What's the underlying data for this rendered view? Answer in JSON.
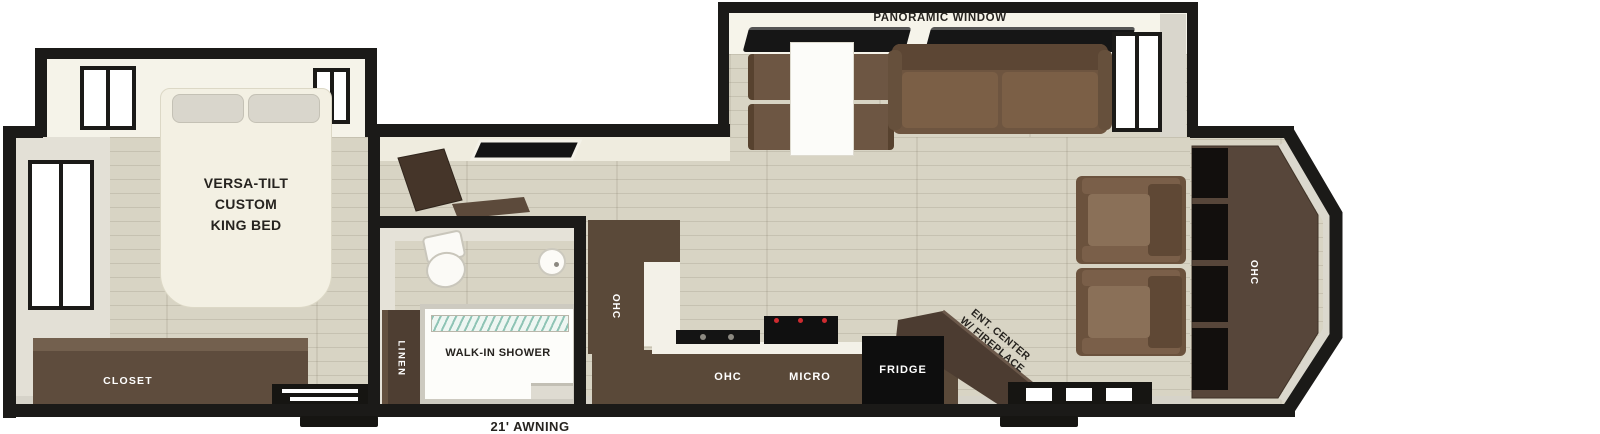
{
  "plan": {
    "front_bedroom": {
      "bed_line1": "VERSA-TILT",
      "bed_line2": "CUSTOM",
      "bed_line3": "KING BED",
      "closet": "CLOSET"
    },
    "bathroom": {
      "linen": "LINEN",
      "shower": "WALK-IN SHOWER"
    },
    "kitchen": {
      "ohc_wall": "OHC",
      "ohc_counter": "OHC",
      "micro": "MICRO",
      "fridge": "FRIDGE"
    },
    "living": {
      "panoramic_window": "PANORAMIC WINDOW",
      "ent_center_line1": "ENT. CENTER",
      "ent_center_line2": "W/ FIREPLACE",
      "ohc_rear": "OHC"
    },
    "exterior": {
      "awning": "21' AWNING"
    },
    "colors": {
      "wall_black": "#1b1a18",
      "floor_beige": "#d8d4c4",
      "cabinet_brown": "#5a4939",
      "sofa_brown": "#6e5540",
      "glass_teal": "#8fc4b5",
      "burner_red": "#cf2b30"
    }
  }
}
